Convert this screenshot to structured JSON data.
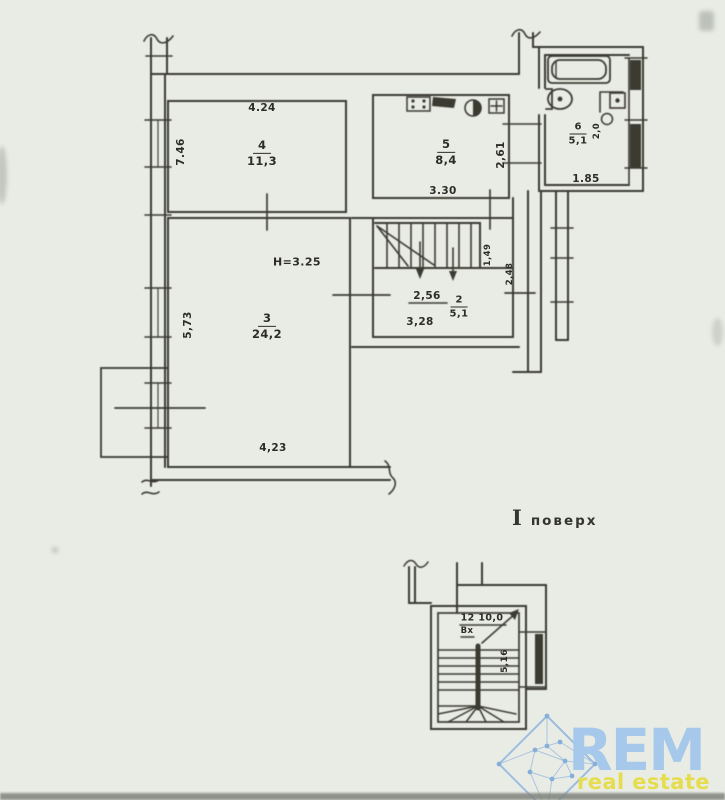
{
  "plan": {
    "floor_caption": {
      "numeral": "І",
      "text": "поверх"
    },
    "rooms": {
      "r4": {
        "number": "4",
        "area": "11,3"
      },
      "r5": {
        "number": "5",
        "area": "8,4"
      },
      "r6": {
        "number": "6",
        "area": "5,1"
      },
      "r3": {
        "number": "3",
        "area": "24,2"
      },
      "r2": {
        "number": "2",
        "area": "5,1"
      }
    },
    "dimensions": {
      "r4_top": "4.24",
      "r4_left": "7.46",
      "r5_bottom": "3.30",
      "r5_right": "2,61",
      "r6_bottom": "1.85",
      "r6_fixture": "2,0",
      "r3_note": "H=3.25",
      "r3_left": "5,73",
      "r3_bottom": "4,23",
      "r2_top": "2,56",
      "r2_bottom": "3,28",
      "stair_right": "1,49",
      "hall_right": "2,48"
    },
    "stairwell": {
      "label": "12 10,0",
      "entry": "Вх",
      "dim_right": "5,16"
    }
  },
  "logo": {
    "name": "REM",
    "tagline": "real estate map",
    "brand_blue": "#a6c8ea",
    "brand_yellow": "#e5dd4e",
    "icon": "diamond-network-icon"
  }
}
